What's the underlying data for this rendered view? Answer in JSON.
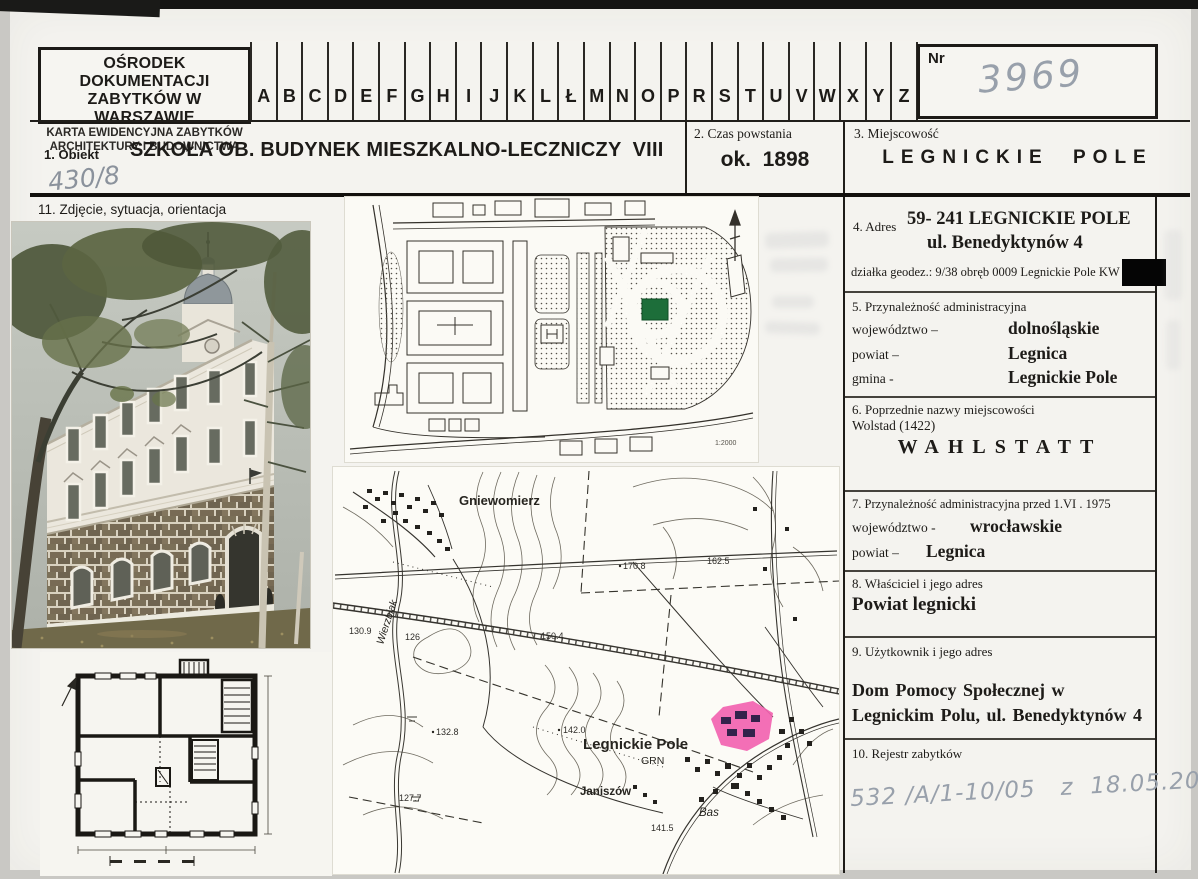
{
  "header": {
    "institution": [
      "OŚRODEK DOKUMENTACJI",
      "ZABYTKÓW W WARSZAWIE"
    ],
    "card_type": [
      "KARTA EWIDENCYJNA ZABYTKÓW",
      "ARCHITEKTURY I BUDOWNICTWA"
    ],
    "index_letters": [
      "A",
      "B",
      "C",
      "D",
      "E",
      "F",
      "G",
      "H",
      "I",
      "J",
      "K",
      "L",
      "Ł",
      "M",
      "N",
      "O",
      "P",
      "R",
      "S",
      "T",
      "U",
      "V",
      "W",
      "X",
      "Y",
      "Z"
    ],
    "nr_label": "Nr",
    "nr_value": "3969"
  },
  "fields": {
    "obiekt": {
      "label": "1. Obiekt",
      "value": "SZKOŁA OB. BUDYNEK MIESZKALNO-LECZNICZY  VIII",
      "handwritten": "430/8"
    },
    "czas": {
      "label": "2. Czas powstania",
      "value": "ok.  1898"
    },
    "miejscowosc": {
      "label": "3. Miejscowość",
      "value": "LEGNICKIE POLE"
    },
    "zdjecie": {
      "label": "11. Zdjęcie, sytuacja, orientacja"
    },
    "adres": {
      "label": "4. Adres",
      "line1": "59- 241 LEGNICKIE POLE",
      "line2": "ul. Benedyktynów 4",
      "line3": "działka geodez.: 9/38 obręb 0009 Legnickie Pole KW"
    },
    "admin": {
      "label": "5. Przynależność administracyjna",
      "rows": [
        {
          "key": "województwo –",
          "value": "dolnośląskie"
        },
        {
          "key": "powiat –",
          "value": "Legnica"
        },
        {
          "key": "gmina -",
          "value": "Legnickie Pole"
        }
      ]
    },
    "former_names": {
      "label": "6. Poprzednie nazwy miejscowości",
      "note": "Wolstad (1422)",
      "value": "WAHLSTATT"
    },
    "admin_before": {
      "label": "7. Przynależność administracyjna przed 1.VI . 1975",
      "rows": [
        {
          "key": "województwo -",
          "value": "wrocławskie"
        },
        {
          "key": "powiat –",
          "value": "Legnica"
        }
      ]
    },
    "owner": {
      "label": "8. Właściciel i jego adres",
      "value": "Powiat legnicki"
    },
    "user": {
      "label": "9. Użytkownik i jego adres",
      "value": "Dom Pomocy Społecznej w Legnickim Polu, ul. Benedyktynów 4"
    },
    "register": {
      "label": "10. Rejestr zabytków",
      "handwritten": "532 /A/1-10/05   z  18.05.2005"
    }
  },
  "site_plan": {
    "scale": "1:2000"
  },
  "topo_map": {
    "places": {
      "gniewomierz": "Gniewomierz",
      "legnickie_pole": "Legnickie Pole",
      "grn": "GRN",
      "janiszow": "Janiszów",
      "bas": "Bas",
      "river": "Wierzbiak"
    },
    "elevations": [
      "130.9",
      "126",
      "150.4",
      "170.8",
      "162.5",
      "142.0",
      "132.8",
      "127.7",
      "141.5"
    ]
  },
  "colors": {
    "highlight_green": "#1d6e3a",
    "highlight_pink": "#f263b0",
    "handwriting_gray": "#98a0ab",
    "redaction": "#000000"
  }
}
